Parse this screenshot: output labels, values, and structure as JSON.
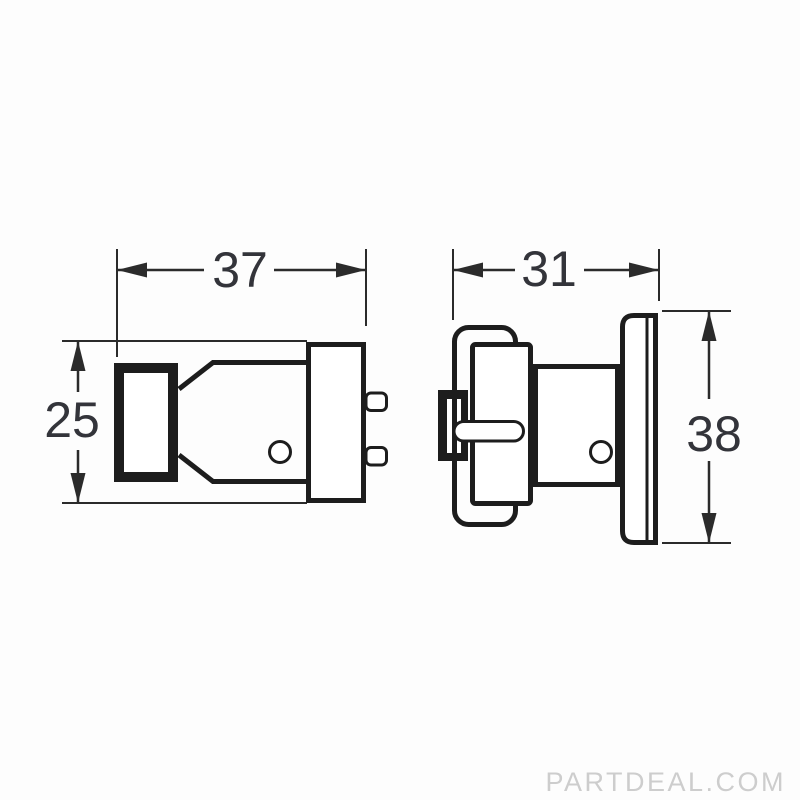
{
  "diagram": {
    "type": "technical-drawing-two-views",
    "views": {
      "left": {
        "name": "side-view",
        "width_label": "37",
        "height_label": "25"
      },
      "right": {
        "name": "end-view",
        "width_label": "31",
        "height_label": "38"
      }
    },
    "colors": {
      "outline": "#1d1d1d",
      "dimension_lines": "#2b2b2b",
      "dimension_text": "#33343a",
      "background": "#fdfdfd",
      "watermark_text_color": "#cdcdcd"
    }
  },
  "watermark": {
    "text": "PARTDEAL.COM"
  }
}
